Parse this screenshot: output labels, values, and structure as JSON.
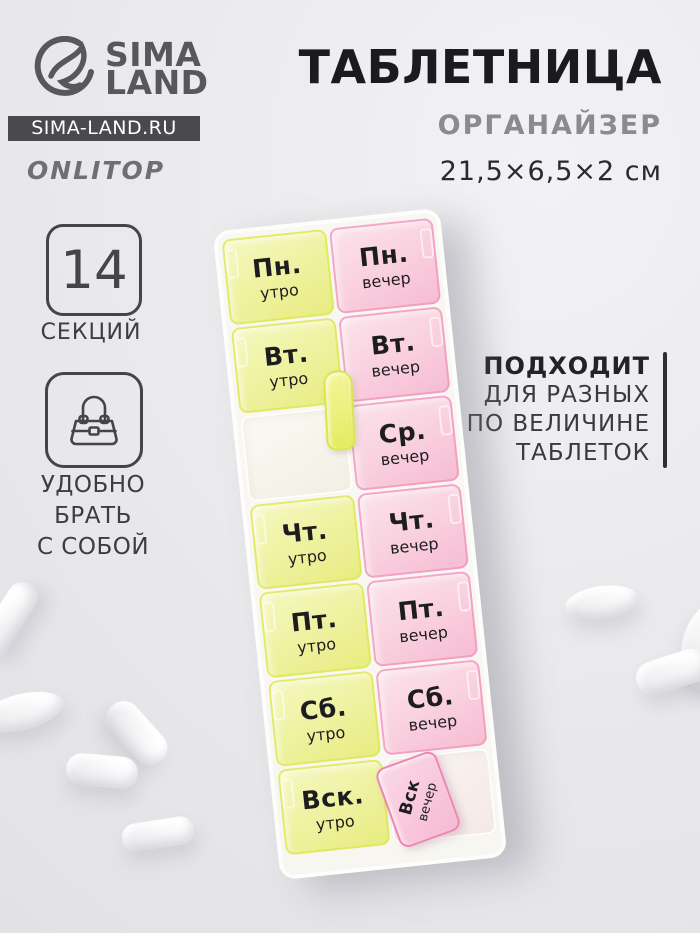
{
  "brand": {
    "logo_top": "SIMA",
    "logo_bottom": "LAND",
    "site_badge": "SIMA-LAND.RU",
    "sub_brand": "ONLITOP"
  },
  "header": {
    "title": "ТАБЛЕТНИЦА",
    "subtitle": "ОРГАНАЙЗЕР",
    "dimensions": "21,5×6,5×2 см"
  },
  "features": {
    "sections_count": "14",
    "sections_label": "СЕКЦИЙ",
    "portable_line1": "УДОБНО БРАТЬ",
    "portable_line2": "С СОБОЙ",
    "fit_heading": "ПОДХОДИТ",
    "fit_line1": "ДЛЯ РАЗНЫХ",
    "fit_line2": "ПО ВЕЛИЧИНЕ",
    "fit_line3": "ТАБЛЕТОК"
  },
  "icons": {
    "logo": "dolphin-logo-icon",
    "portable": "handbag-icon"
  },
  "pillbox": {
    "left_column": [
      {
        "day": "Пн.",
        "time": "утро"
      },
      {
        "day": "Вт.",
        "time": "утро"
      },
      {
        "day": "",
        "time": ""
      },
      {
        "day": "Чт.",
        "time": "утро"
      },
      {
        "day": "Пт.",
        "time": "утро"
      },
      {
        "day": "Сб.",
        "time": "утро"
      },
      {
        "day": "Вск.",
        "time": "утро"
      }
    ],
    "right_column": [
      {
        "day": "Пн.",
        "time": "вечер"
      },
      {
        "day": "Вт.",
        "time": "вечер"
      },
      {
        "day": "Ср.",
        "time": "вечер"
      },
      {
        "day": "Чт.",
        "time": "вечер"
      },
      {
        "day": "Пт.",
        "time": "вечер"
      },
      {
        "day": "Сб.",
        "time": "вечер"
      },
      {
        "day": "",
        "time": ""
      }
    ],
    "open_lid": {
      "day": "Вск",
      "time": "вечер"
    }
  },
  "colors": {
    "yellow_edge": "#e4ec62",
    "pink_edge": "#f49ec4",
    "badge_bg": "#4a4a4d",
    "text_dark": "#1b1b1d"
  }
}
